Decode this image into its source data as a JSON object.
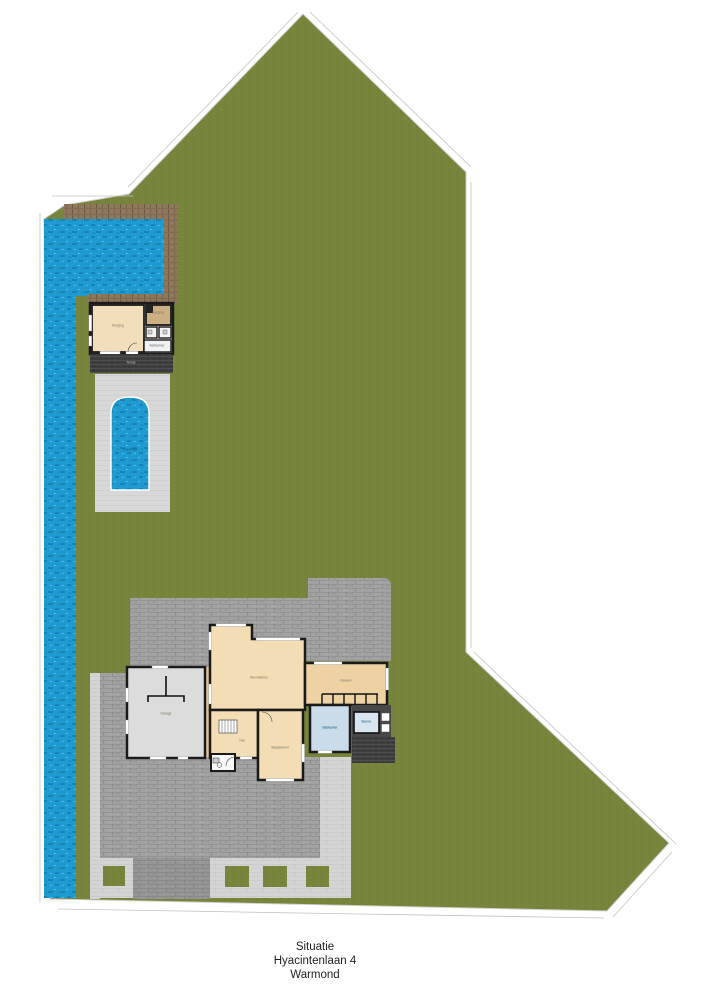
{
  "title": "Situatie Hyacintenlaan 4 Warmond",
  "footer": {
    "line1": "Situatie",
    "line2": "Hyacintenlaan 4",
    "line3": "Warmond"
  },
  "rooms": {
    "garage": "Garage",
    "living_room": "Woonkamer",
    "kitchen": "Keuken",
    "bathroom": "Badkamer",
    "sauna": "Sauna",
    "hall": "Hal",
    "bedroom": "Slaapkamer",
    "pool": "Zwembad",
    "terrace": "Terras",
    "garden_house_main": "Berging",
    "garden_house_storage": "Berging",
    "garden_house_bath": "Badkamer"
  },
  "colors": {
    "grass": "#76853b",
    "water": "#1f9bd1",
    "paving_dark": "#a2a2a2",
    "paving_light": "#d4d4d4",
    "deck_wood": "#8d765a",
    "deck_dark": "#3e3e3e",
    "house_floor_cream": "#f2ddb5",
    "house_floor_tan": "#cdaf84",
    "bath_blue": "#cadbe9",
    "wall_black": "#1a1a1a"
  }
}
